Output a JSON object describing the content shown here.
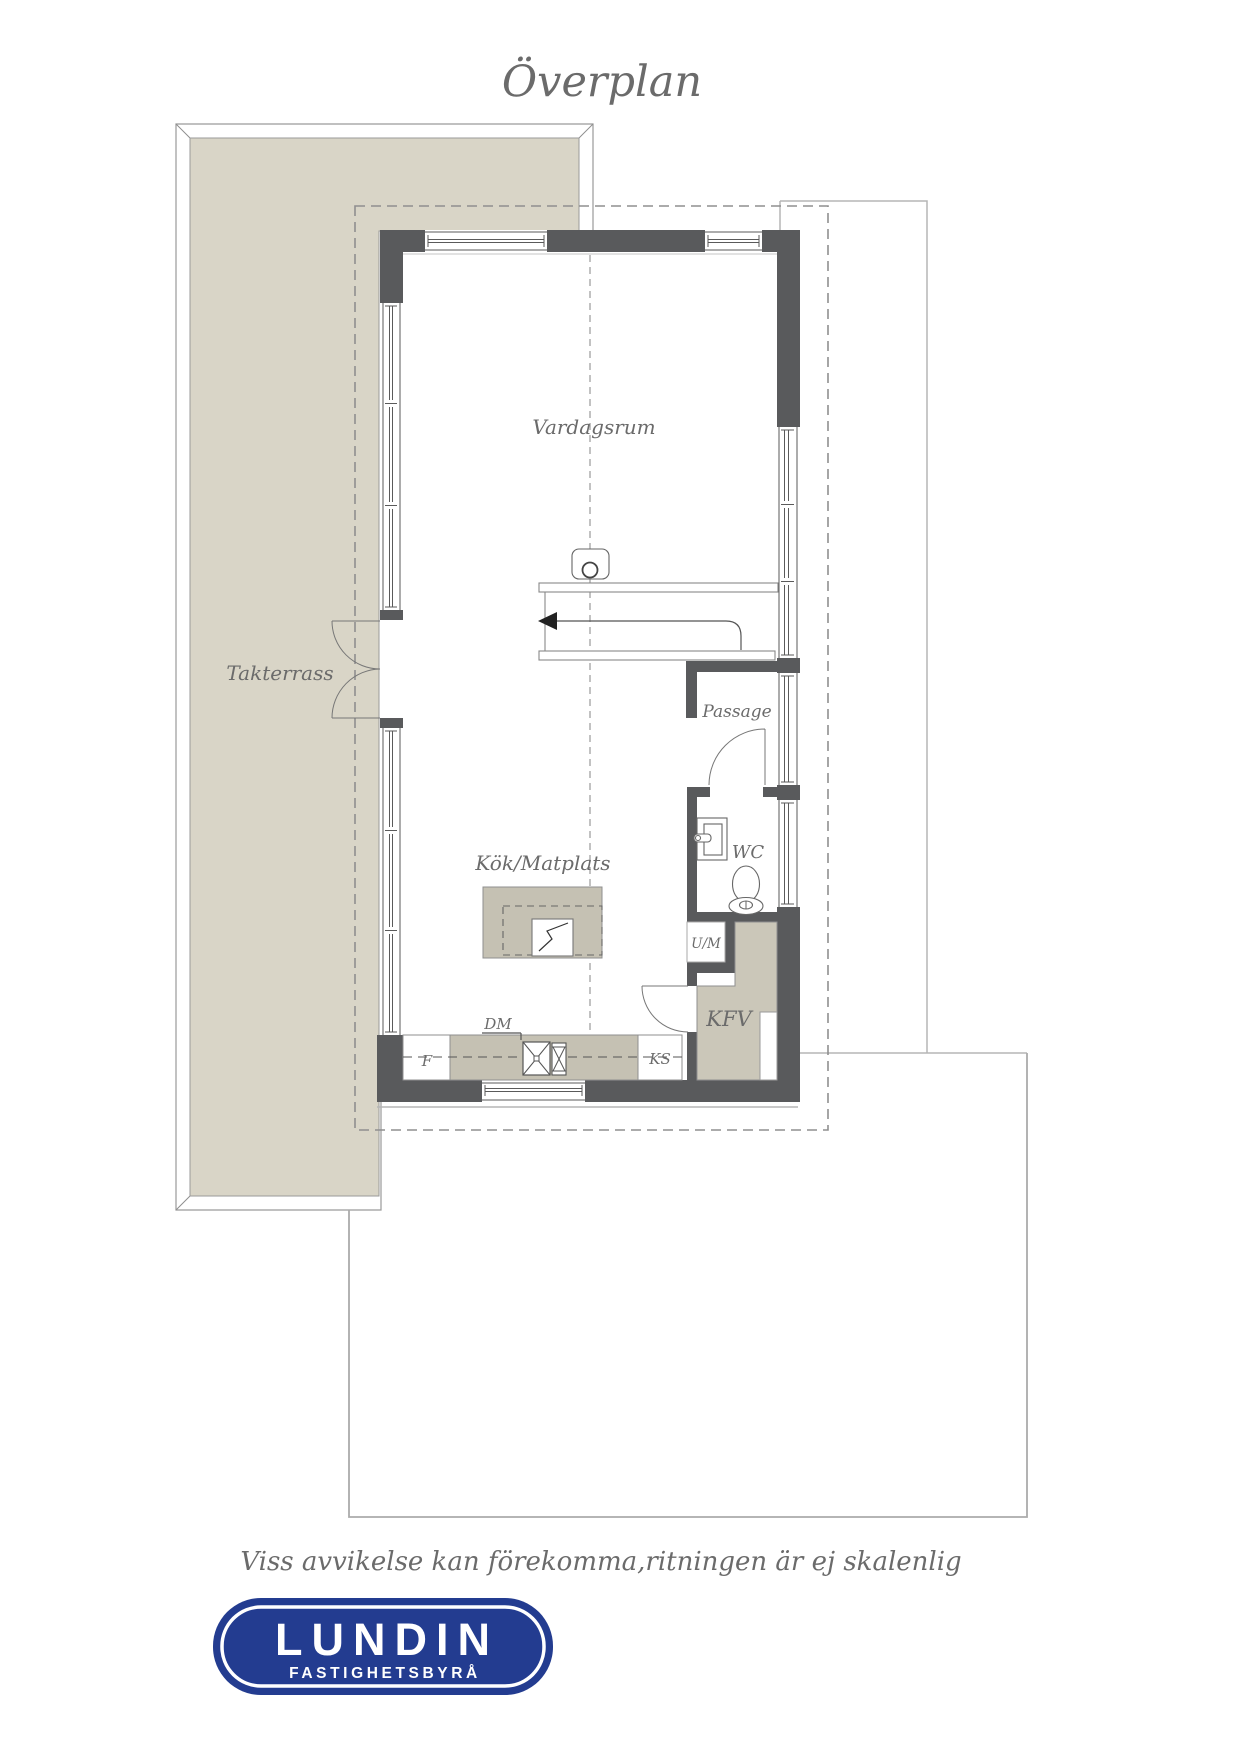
{
  "title": "Överplan",
  "rooms": {
    "living": "Vardagsrum",
    "terrace": "Takterrass",
    "passage": "Passage",
    "wc": "WC",
    "kitchen": "Kök/Matplats",
    "kfv": "KFV"
  },
  "appliances": {
    "um": "U/M",
    "dm": "DM",
    "fridge": "F",
    "ks": "KS"
  },
  "disclaimer": "Viss avvikelse kan förekomma,ritningen är ej skalenlig",
  "logo": {
    "name": "LUNDIN",
    "subtitle": "FASTIGHETSBYRÅ"
  },
  "colors": {
    "wall": "#595a5c",
    "terrace": "#d9d5c7",
    "cabinet": "#c5c1b3",
    "kfv_fill": "#cbc7b9",
    "logo_navy": "#233c90",
    "label_gray": "#6b6b6b"
  }
}
